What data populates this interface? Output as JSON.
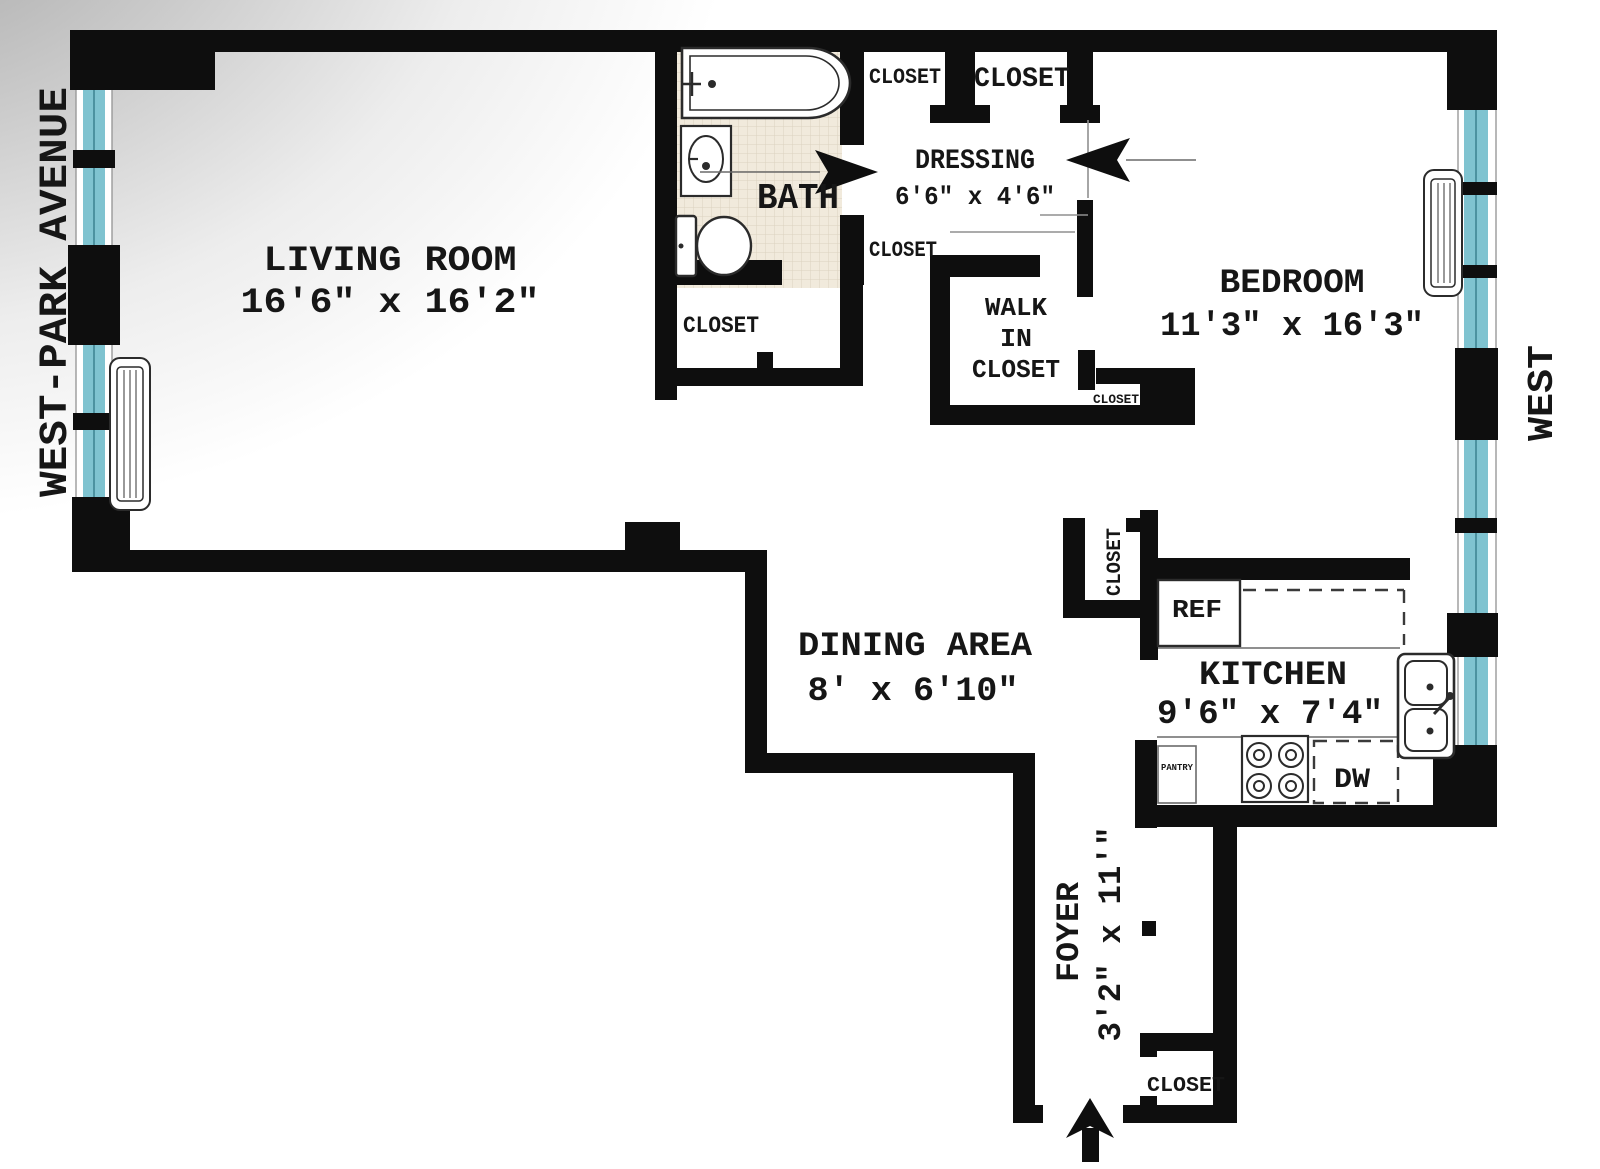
{
  "plan": {
    "streets": {
      "left": "WEST-PARK AVENUE",
      "right": "WEST"
    },
    "rooms": {
      "living_room": {
        "name": "LIVING ROOM",
        "dims": "16'6\" x 16'2\""
      },
      "bath": {
        "name": "BATH"
      },
      "dressing": {
        "name": "DRESSING",
        "dims": "6'6\" x 4'6\""
      },
      "bedroom": {
        "name": "BEDROOM",
        "dims": "11'3\" x 16'3\""
      },
      "walk_in_closet": {
        "line1": "WALK",
        "line2": "IN",
        "line3": "CLOSET"
      },
      "dining": {
        "name": "DINING AREA",
        "dims": "8' x 6'10\""
      },
      "kitchen": {
        "name": "KITCHEN",
        "dims": "9'6\" x 7'4\""
      },
      "foyer": {
        "name": "FOYER",
        "dims": "3'2\" x 11'\""
      }
    },
    "closets": {
      "top_small": "CLOSET",
      "top_large": "CLOSET",
      "mid": "CLOSET",
      "living": "CLOSET",
      "bedroom_small": "CLOSET",
      "foyer_top": "CLOSET",
      "foyer_bottom": "CLOSET"
    },
    "appliances": {
      "ref": "REF",
      "dw": "DW",
      "pantry": "PANTRY"
    },
    "colors": {
      "wall": "#0e0e0e",
      "window_glass": "#7fc3d0",
      "window_glass_dark": "#3f8694",
      "tile": "#f1eadc",
      "tile_line": "#dcd2bf"
    }
  }
}
